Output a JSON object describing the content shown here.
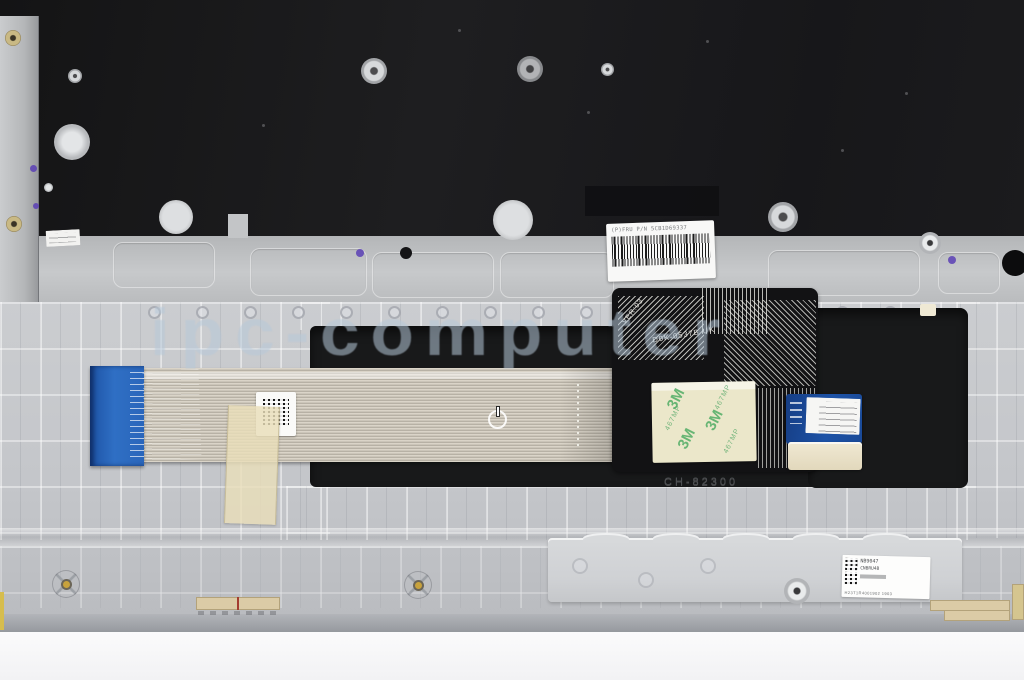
{
  "watermark": {
    "text": "ipc-computer",
    "color": "#b9c9da"
  },
  "labels": {
    "fru_barcode": "(P)FRU P/N 5CB1D69337",
    "flex_version": "VER:03",
    "flex_model": "D0K-0537B UK",
    "sticker_brand": "3M",
    "sticker_model": "467MP",
    "embossed_code": "CH-82300",
    "bracket_label": {
      "part": "NB9047",
      "code": "CNBRU4B",
      "serial": "H23T1R4001902 1903"
    }
  },
  "colors": {
    "keyboard_backplate": "#1b1b1d",
    "metal_plate": "#bfc1c3",
    "palmrest": "#c6c8cb",
    "cable_ribbon": "#cdc7bb",
    "connector_blue": "#2e6bbf",
    "touchpad_pcb_blue": "#1d4fa0",
    "sticker_green": "#3aa55a",
    "tape_beige": "#e9deba",
    "foam_cream": "#e9e0c8",
    "background_white": "#fcfcfd"
  }
}
